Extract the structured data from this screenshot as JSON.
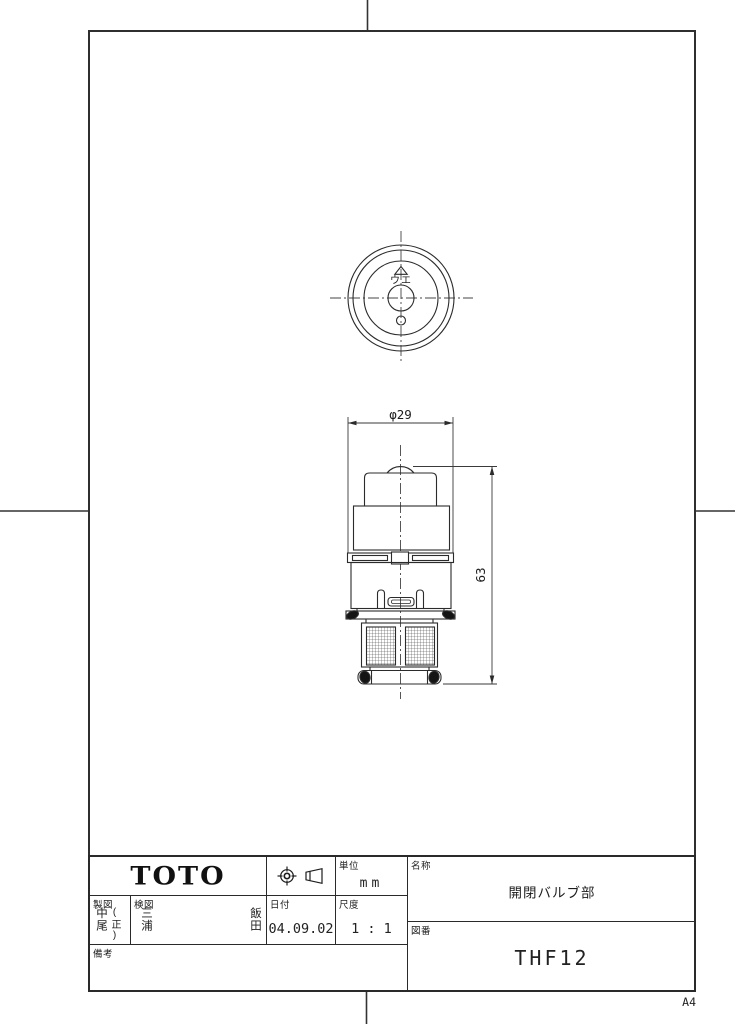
{
  "page": {
    "paper_size": "A4"
  },
  "title_block": {
    "logo": "TOTO",
    "projection_symbol": "first-angle-projection",
    "unit": {
      "label": "単位",
      "value": "mm"
    },
    "date": {
      "label": "日付",
      "value": "04.09.02"
    },
    "scale": {
      "label": "尺度",
      "value": "1 : 1"
    },
    "drafter": {
      "label": "製図",
      "name": "中尾",
      "annotation": "(正)"
    },
    "checker": {
      "label": "検図",
      "name_1": "三浦",
      "name_2": "飯田"
    },
    "remarks": {
      "label": "備考",
      "value": ""
    },
    "part_name": {
      "label": "名称",
      "value": "開閉バルブ部"
    },
    "drawing_number": {
      "label": "図番",
      "value": "THF12"
    }
  },
  "drawing": {
    "dim_diameter": "φ29",
    "dim_height": "63",
    "orientation_label": "ウエ"
  },
  "colors": {
    "line": "#2b2b2b",
    "thin_line": "#444444",
    "paper": "#ffffff"
  }
}
